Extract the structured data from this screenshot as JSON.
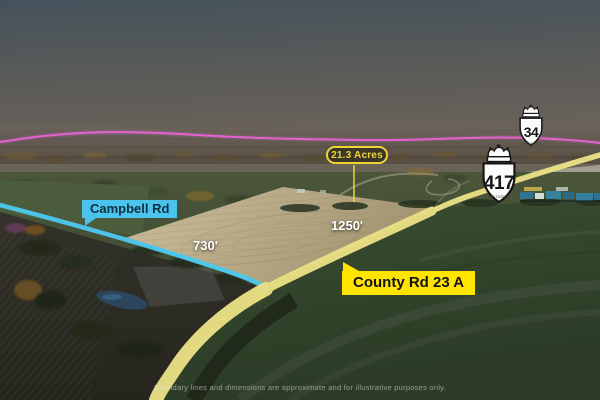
{
  "annotations": {
    "acreage": "21.3 Acres",
    "dim_west": "730'",
    "dim_east": "1250'",
    "road_campbell": "Campbell Rd",
    "road_county": "County Rd 23 A",
    "disclaimer": "Boundary lines and dimensions are approximate and for illustrative purposes only."
  },
  "shields": [
    {
      "number": "34",
      "subtext": "ONTARIO"
    },
    {
      "number": "417",
      "subtext": "ONTARIO"
    }
  ],
  "colors": {
    "campbell_label_bg": "#4ac4ec",
    "campbell_label_text": "#0c2f42",
    "county_label_bg": "#ffe400",
    "county_label_text": "#131313",
    "acreage_accent": "#f0d435",
    "road_highlight_yellow": "#eae085",
    "road_highlight_cyan": "#4cc8f0",
    "boundary_magenta": "#f163dd",
    "dimension_text": "#ffffff"
  }
}
